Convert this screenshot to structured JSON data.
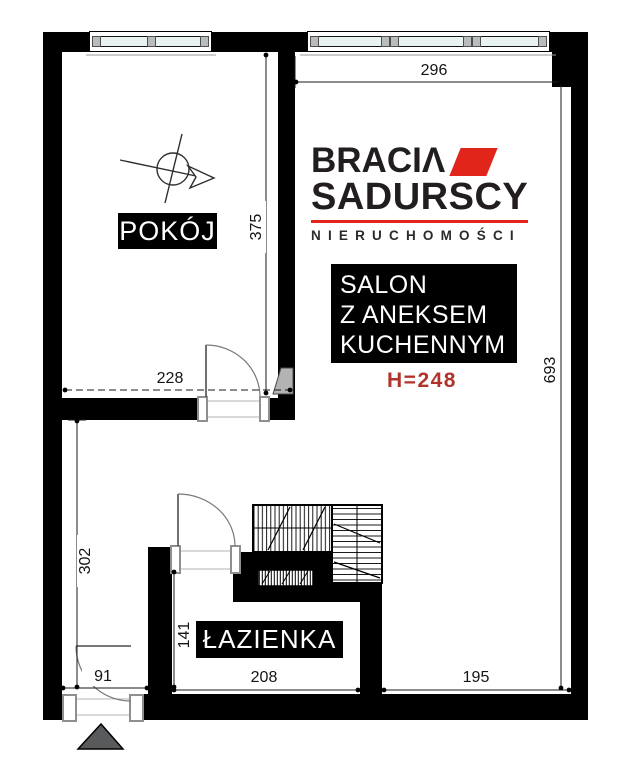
{
  "brand": {
    "name_line1": "BRACIΛ",
    "name_line2": "SADURSCY",
    "tagline": "NIERUCHOMOŚCI",
    "red": "#e1251b",
    "dark": "#221e1f"
  },
  "labels": {
    "room1": "POKÓJ",
    "salon_lines": [
      "SALON",
      "Z ANEKSEM",
      "KUCHENNYM"
    ],
    "bathroom": "ŁAZIENKA",
    "ceiling_height": "H=248"
  },
  "dimensions": {
    "salon_width": "296",
    "room1_height": "375",
    "room1_width": "228",
    "salon_height": "693",
    "hall_height": "302",
    "bathroom_height": "141",
    "entry_width": "91",
    "bathroom_width": "208",
    "salon_bottom_width": "195"
  },
  "colors": {
    "wall": "#000000",
    "window_glass": "#e8f2f0",
    "ceiling_height_red": "#b0342c",
    "entry_arrow_gray": "#595a5c",
    "door_wedge_gray": "#b3b3b3"
  }
}
